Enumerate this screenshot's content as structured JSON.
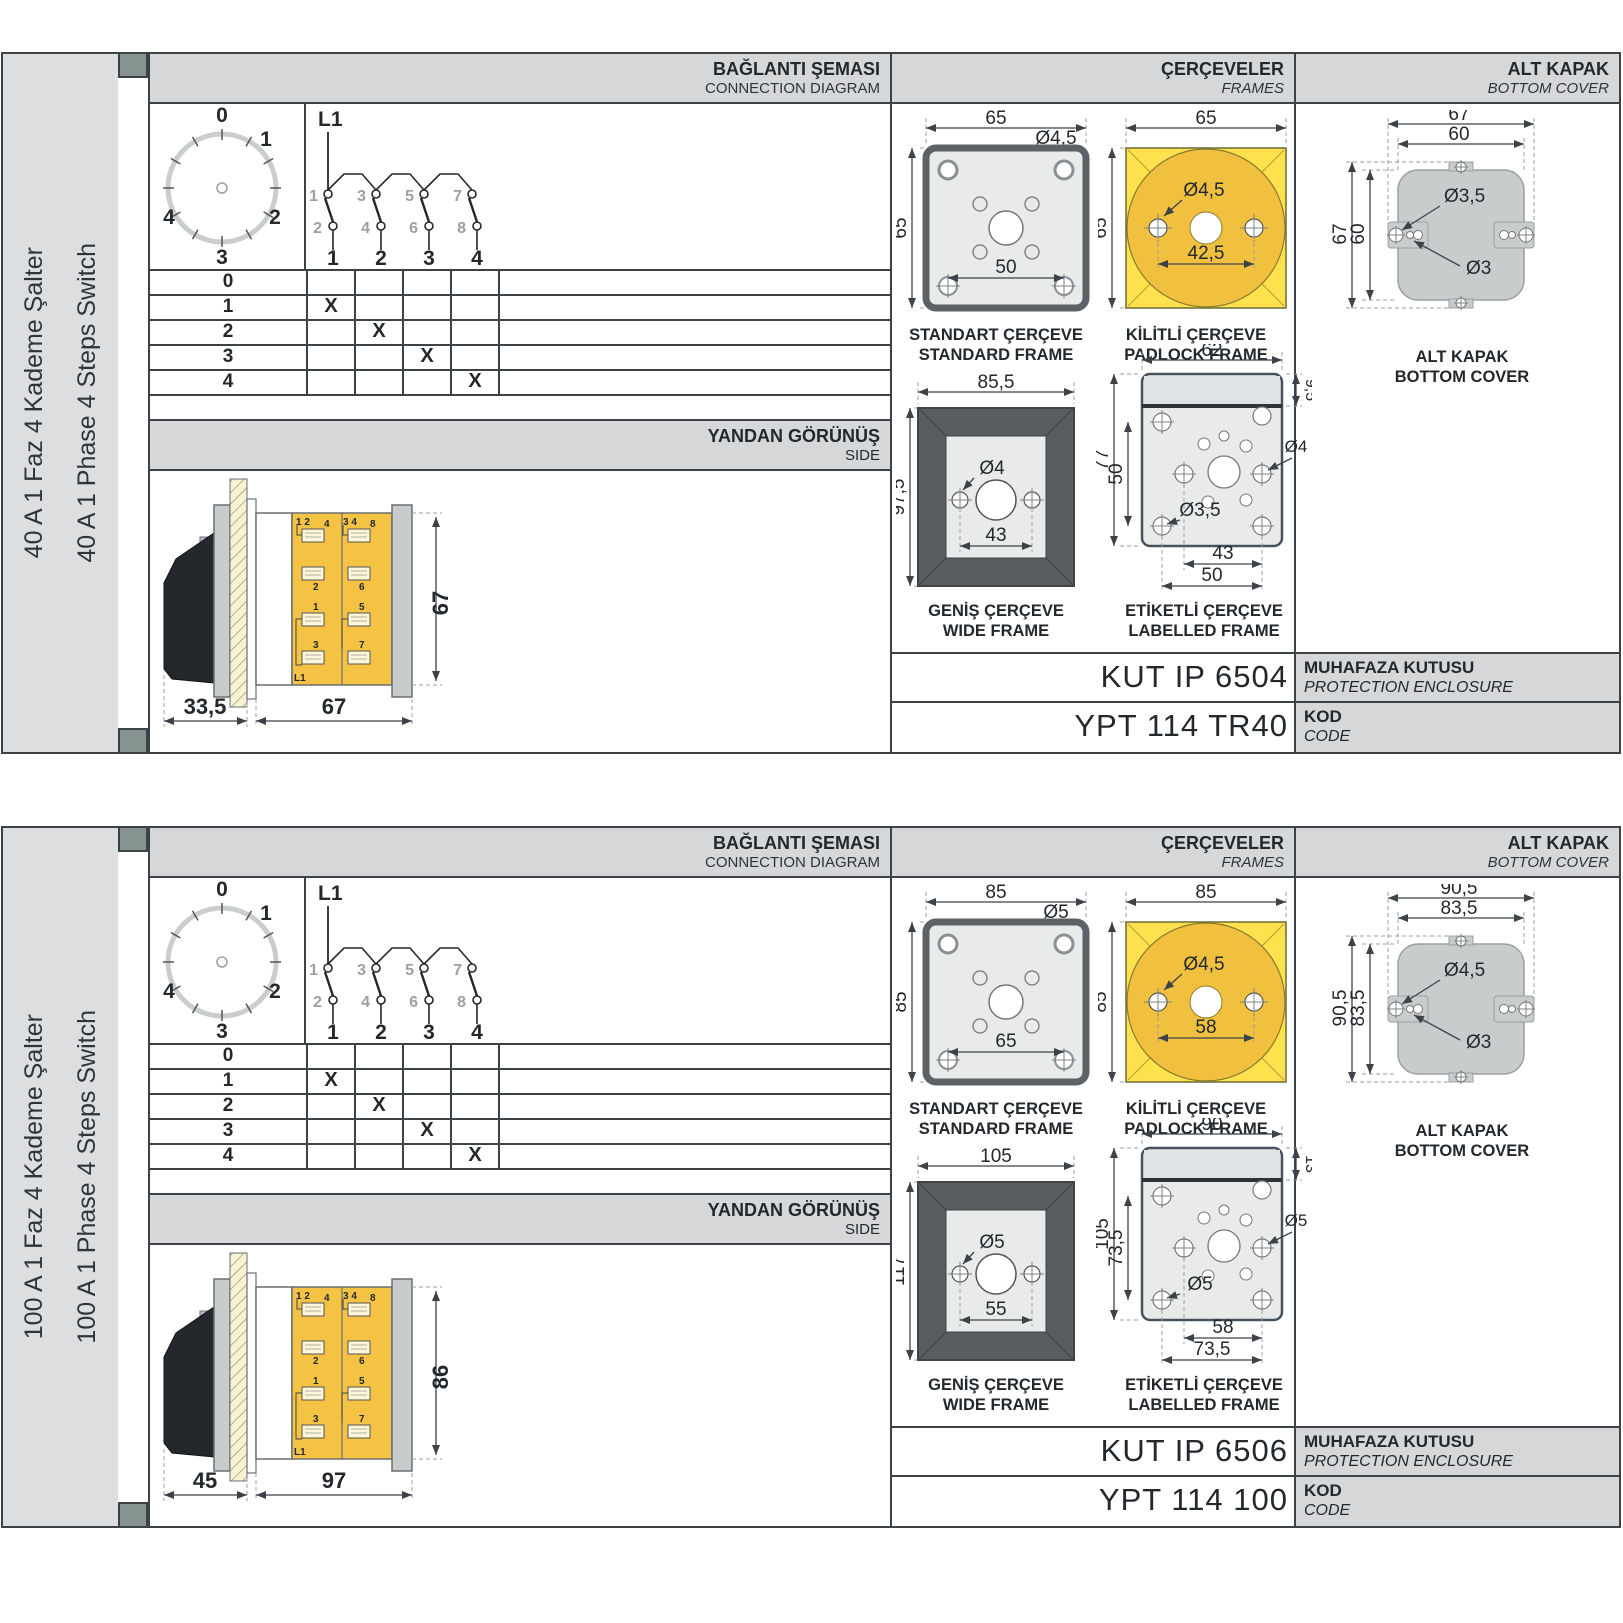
{
  "colors": {
    "header_bg": "#d5d7d9",
    "sidebar_bg": "#dcdee0",
    "marker_square": "#879390",
    "border": "#3c4247",
    "padlock_yellow": "#ffe14d",
    "padlock_gold": "#f0c03e",
    "body_yellow": "#f5c343",
    "frame_fill": "#e9ebeb",
    "wide_frame_dark": "#585d62",
    "cover_fill": "#c9cccd"
  },
  "sections": [
    {
      "side_label_tr": "40 A 1 Faz 4 Kademe Şalter",
      "side_label_en": "40 A 1 Phase 4 Steps Switch",
      "headers": {
        "conn_tr": "BAĞLANTI ŞEMASI",
        "conn_en": "CONNECTION DIAGRAM",
        "frames_tr": "ÇERÇEVELER",
        "frames_en": "FRAMES",
        "cover_tr": "ALT KAPAK",
        "cover_en": "BOTTOM COVER"
      },
      "dial": [
        "0",
        "1",
        "2",
        "3",
        "4"
      ],
      "circuit": {
        "feed": "L1",
        "top": [
          "1",
          "3",
          "5",
          "7"
        ],
        "bottom": [
          "2",
          "4",
          "6",
          "8"
        ],
        "out": [
          "1",
          "2",
          "3",
          "4"
        ]
      },
      "switch_table": {
        "rows": [
          {
            "label": "0",
            "c": [
              "",
              "",
              "",
              ""
            ]
          },
          {
            "label": "1",
            "c": [
              "X",
              "",
              "",
              ""
            ]
          },
          {
            "label": "2",
            "c": [
              "",
              "X",
              "",
              ""
            ]
          },
          {
            "label": "3",
            "c": [
              "",
              "",
              "X",
              ""
            ]
          },
          {
            "label": "4",
            "c": [
              "",
              "",
              "",
              "X"
            ]
          }
        ]
      },
      "side_view": {
        "band_tr": "YANDAN GÖRÜNÜŞ",
        "band_en": "SIDE",
        "dim_front": "33,5",
        "dim_body": "67",
        "dim_height": "67",
        "labels1": {
          "pair": "1 2",
          "a": "4",
          "b": "2",
          "c": "1",
          "d": "3",
          "feed": "L1"
        },
        "labels2": {
          "pair": "3 4",
          "a": "8",
          "b": "6",
          "c": "5",
          "d": "7"
        }
      },
      "frames": {
        "standard": {
          "w": "65",
          "h": "65",
          "hole": "Ø4,5",
          "pitch": "50",
          "cap_tr": "STANDART ÇERÇEVE",
          "cap_en": "STANDARD FRAME"
        },
        "padlock": {
          "w": "65",
          "h": "65",
          "hole": "Ø4,5",
          "pitch": "42,5",
          "cap_tr": "KİLİTLİ ÇERÇEVE",
          "cap_en": "PADLOCK FRAME"
        },
        "wide": {
          "w": "85,5",
          "h": "97,5",
          "hole": "Ø4",
          "pitch": "43",
          "cap_tr": "GENİŞ ÇERÇEVE",
          "cap_en": "WIDE FRAME"
        },
        "labelled": {
          "w": "62",
          "band": "9,5",
          "h": "77",
          "inner_h": "50",
          "hole_r": "Ø4",
          "hole_l": "Ø3,5",
          "pitch1": "43",
          "pitch2": "50",
          "cap_tr": "ETİKETLİ ÇERÇEVE",
          "cap_en": "LABELLED FRAME"
        }
      },
      "bottom_cover": {
        "w1": "67",
        "w2": "60",
        "h1": "67",
        "h2": "60",
        "hole1": "Ø3,5",
        "hole2": "Ø3",
        "cap_tr": "ALT KAPAK",
        "cap_en": "BOTTOM COVER"
      },
      "codes": {
        "box": "KUT IP 6504",
        "box_tr": "MUHAFAZA KUTUSU",
        "box_en": "PROTECTION ENCLOSURE",
        "code": "YPT 114 TR40",
        "code_tr": "KOD",
        "code_en": "CODE"
      }
    },
    {
      "side_label_tr": "100 A 1 Faz 4 Kademe Şalter",
      "side_label_en": "100 A 1 Phase 4 Steps Switch",
      "headers": {
        "conn_tr": "BAĞLANTI ŞEMASI",
        "conn_en": "CONNECTION DIAGRAM",
        "frames_tr": "ÇERÇEVELER",
        "frames_en": "FRAMES",
        "cover_tr": "ALT KAPAK",
        "cover_en": "BOTTOM COVER"
      },
      "dial": [
        "0",
        "1",
        "2",
        "3",
        "4"
      ],
      "circuit": {
        "feed": "L1",
        "top": [
          "1",
          "3",
          "5",
          "7"
        ],
        "bottom": [
          "2",
          "4",
          "6",
          "8"
        ],
        "out": [
          "1",
          "2",
          "3",
          "4"
        ]
      },
      "switch_table": {
        "rows": [
          {
            "label": "0",
            "c": [
              "",
              "",
              "",
              ""
            ]
          },
          {
            "label": "1",
            "c": [
              "X",
              "",
              "",
              ""
            ]
          },
          {
            "label": "2",
            "c": [
              "",
              "X",
              "",
              ""
            ]
          },
          {
            "label": "3",
            "c": [
              "",
              "",
              "X",
              ""
            ]
          },
          {
            "label": "4",
            "c": [
              "",
              "",
              "",
              "X"
            ]
          }
        ]
      },
      "side_view": {
        "band_tr": "YANDAN GÖRÜNÜŞ",
        "band_en": "SIDE",
        "dim_front": "45",
        "dim_body": "97",
        "dim_height": "86",
        "labels1": {
          "pair": "1 2",
          "a": "4",
          "b": "2",
          "c": "1",
          "d": "3",
          "feed": "L1"
        },
        "labels2": {
          "pair": "3 4",
          "a": "8",
          "b": "6",
          "c": "5",
          "d": "7"
        }
      },
      "frames": {
        "standard": {
          "w": "85",
          "h": "85",
          "hole": "Ø5",
          "pitch": "65",
          "cap_tr": "STANDART ÇERÇEVE",
          "cap_en": "STANDARD FRAME"
        },
        "padlock": {
          "w": "85",
          "h": "85",
          "hole": "Ø4,5",
          "pitch": "58",
          "cap_tr": "KİLİTLİ ÇERÇEVE",
          "cap_en": "PADLOCK FRAME"
        },
        "wide": {
          "w": "105",
          "h": "117",
          "hole": "Ø5",
          "pitch": "55",
          "cap_tr": "GENİŞ ÇERÇEVE",
          "cap_en": "WIDE FRAME"
        },
        "labelled": {
          "w": "90",
          "band": "13",
          "h": "105",
          "inner_h": "73,5",
          "hole_r": "Ø5",
          "hole_l": "Ø5",
          "pitch1": "58",
          "pitch2": "73,5",
          "cap_tr": "ETİKETLİ ÇERÇEVE",
          "cap_en": "LABELLED FRAME"
        }
      },
      "bottom_cover": {
        "w1": "90,5",
        "w2": "83,5",
        "h1": "90,5",
        "h2": "83,5",
        "hole1": "Ø4,5",
        "hole2": "Ø3",
        "cap_tr": "ALT KAPAK",
        "cap_en": "BOTTOM COVER"
      },
      "codes": {
        "box": "KUT IP 6506",
        "box_tr": "MUHAFAZA KUTUSU",
        "box_en": "PROTECTION ENCLOSURE",
        "code": "YPT 114 100",
        "code_tr": "KOD",
        "code_en": "CODE"
      }
    }
  ]
}
